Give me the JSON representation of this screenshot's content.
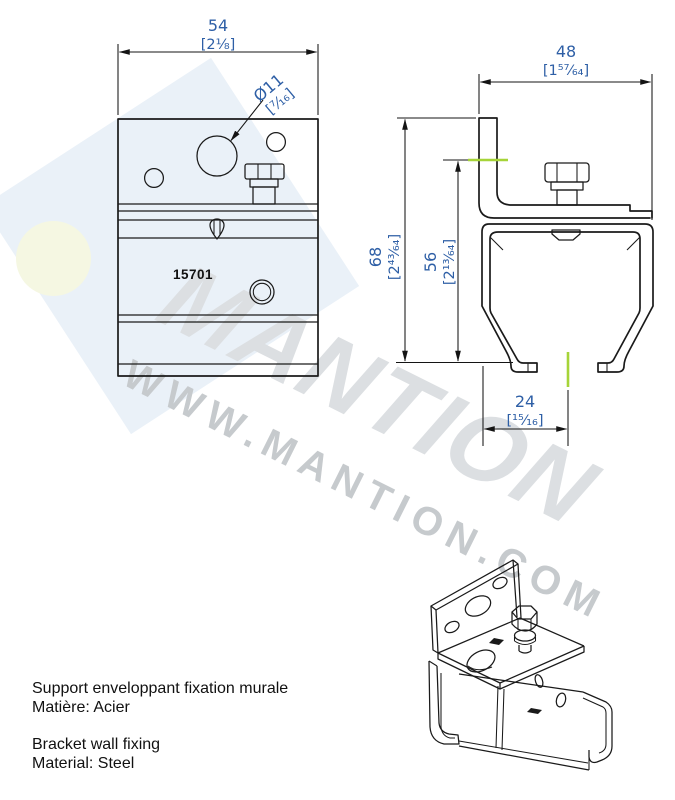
{
  "watermark": {
    "brand": "MANTION",
    "url": "WWW.MANTION.COM",
    "square_color": "#eaf1f8",
    "circle_color": "#f5f7e2",
    "brand_color": "#dcdfe2",
    "url_color": "#c6cacd"
  },
  "drawing": {
    "line_color": "#1a1a1a",
    "dimension_color": "#2e5fa6",
    "highlight_color": "#a6d438"
  },
  "front_view": {
    "part_number": "15701",
    "width_mm": "54",
    "width_in": "[2⅛]",
    "hole_dia_mm": "Ø11",
    "hole_dia_in": "[⁷⁄₁₆]"
  },
  "side_view": {
    "width_mm": "48",
    "width_in": "[1⁵⁷⁄₆₄]",
    "total_height_mm": "68",
    "total_height_in": "[2⁴³⁄₆₄]",
    "body_height_mm": "56",
    "body_height_in": "[2¹³⁄₆₄]",
    "center_offset_mm": "24",
    "center_offset_in": "[¹⁵⁄₁₆]"
  },
  "description": {
    "fr_title": "Support enveloppant fixation murale",
    "fr_material": "Matière: Acier",
    "en_title": "Bracket wall fixing",
    "en_material": "Material: Steel"
  }
}
